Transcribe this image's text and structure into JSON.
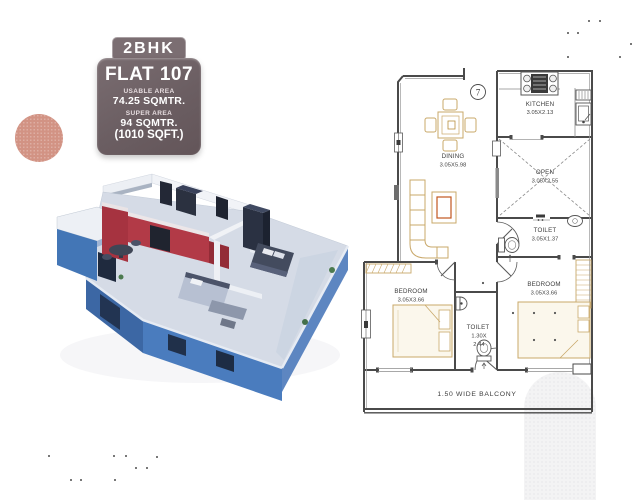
{
  "badge": {
    "type_label": "2BHK",
    "flat_label": "FLAT 107",
    "usable_area_label": "USABLE AREA",
    "usable_area_value": "74.25 SQMTR.",
    "super_area_label": "SUPER AREA",
    "super_area_value": "94 SQMTR.",
    "super_area_sqft": "(1010 SQFT.)"
  },
  "floorplan": {
    "unit_number": "7",
    "kitchen_name": "KITCHEN",
    "kitchen_dims": "3.05X2.13",
    "dining_name": "DINING",
    "dining_dims": "3.05X5.98",
    "open_name": "OPEN",
    "open_dims": "3.05X2.55",
    "toilet_right_name": "TOILET",
    "toilet_right_dims": "3.05X1.37",
    "bedroom_left_name": "BEDROOM",
    "bedroom_left_dims": "3.05X3.66",
    "bedroom_right_name": "BEDROOM",
    "bedroom_right_dims": "3.05X3.66",
    "toilet_mid_name": "TOILET",
    "toilet_mid_dims1": "1.30X",
    "toilet_mid_dims2": "2.44",
    "balcony_label": "1.50 WIDE BALCONY"
  },
  "colors": {
    "badge_bg": "#6b5e62",
    "accent_pink": "#d29384",
    "plan_blue": "#4a7cbe",
    "plan_red": "#b23a47"
  }
}
